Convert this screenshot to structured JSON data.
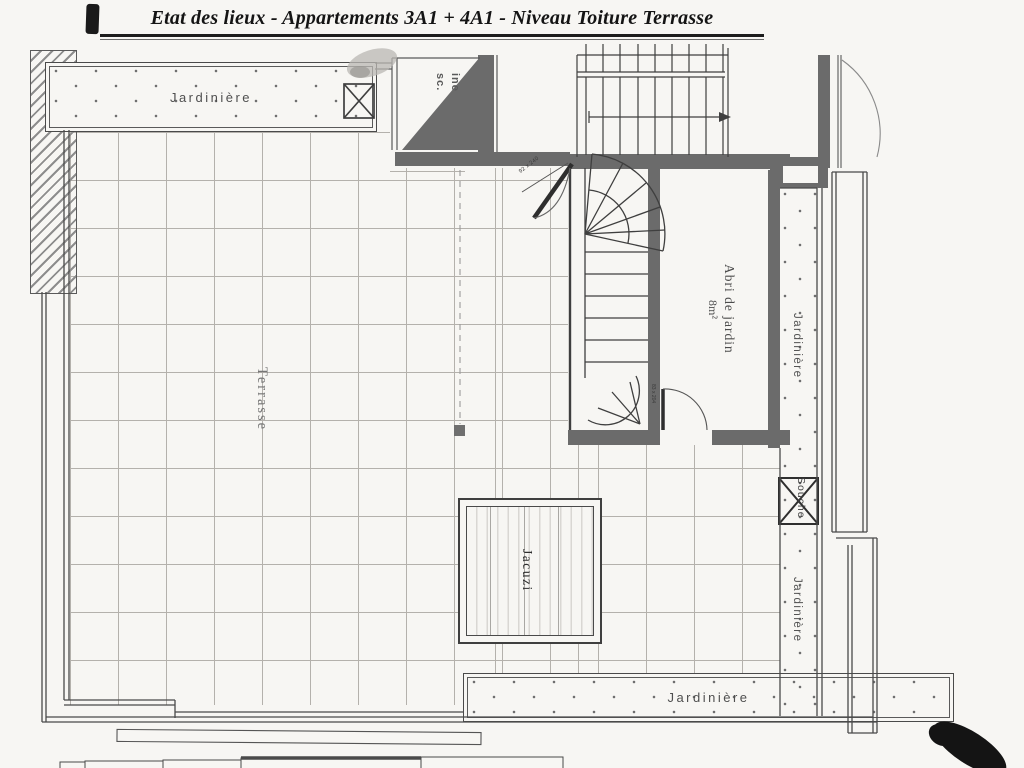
{
  "document": {
    "title": "Etat des lieux - Appartements 3A1 + 4A1 - Niveau Toiture Terrasse"
  },
  "plan": {
    "terrace_label": "Terrasse",
    "jacuzzi_label": "Jacuzi",
    "shed_label": "Abri de jardin",
    "shed_area": "8m²",
    "flue_label": "Souche",
    "shaft_label_line1": "ine",
    "shaft_label_line2": "sc.",
    "planter_top_label": "Jardinière",
    "planter_right_upper_label": "Jardinière",
    "planter_right_lower_label": "Jardinière",
    "planter_bottom_label": "Jardinière",
    "door_dimension_stair": "92 x 240",
    "door_dimension_shed": "83 x 204"
  },
  "colors": {
    "paper": "#f7f6f3",
    "ink": "#141414",
    "wall_fill": "#6b6b6b",
    "line": "#4a4a4a",
    "grid_line": "#b4b1ac",
    "label_text": "#545454"
  }
}
